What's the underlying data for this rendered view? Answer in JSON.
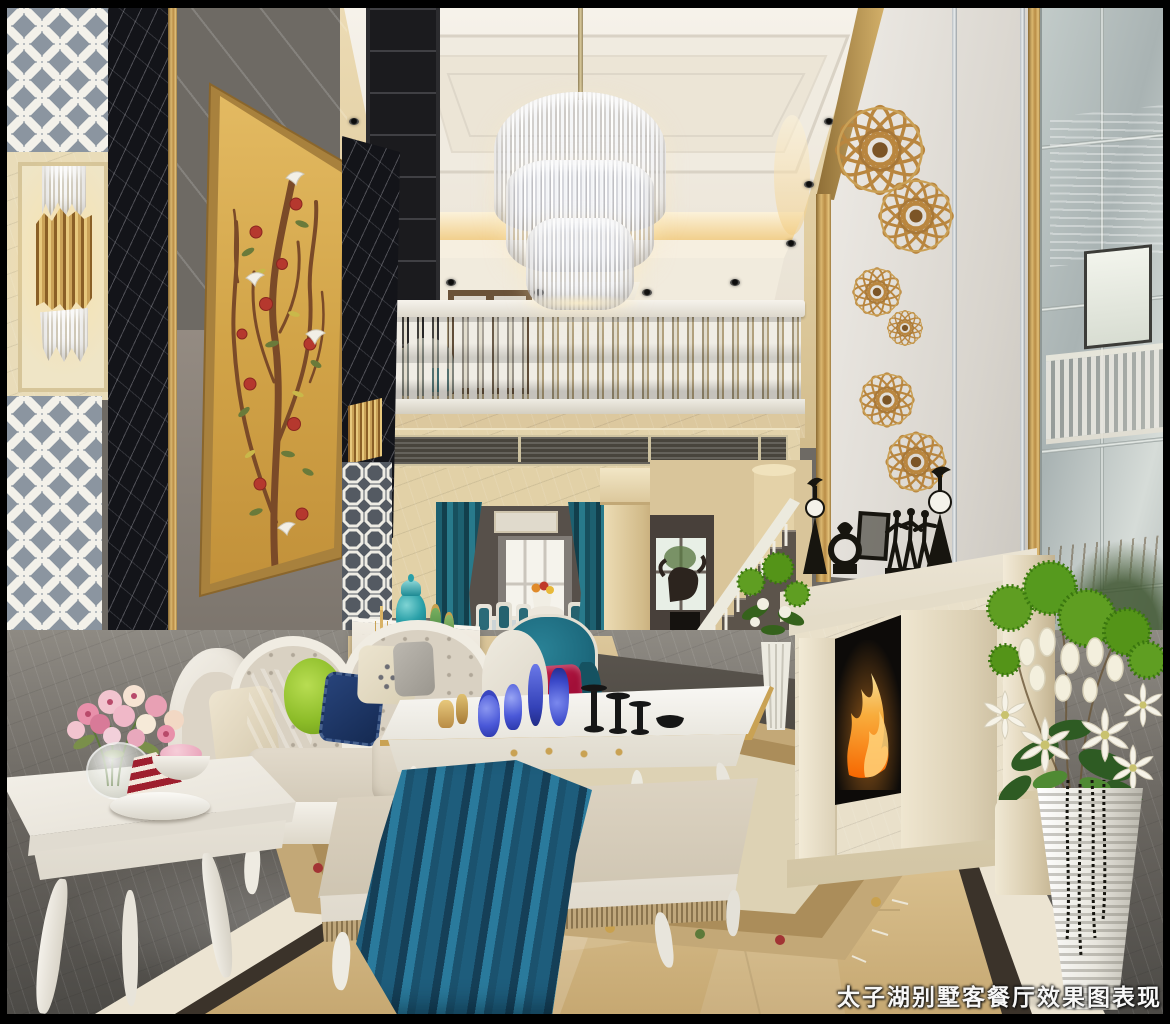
{
  "watermark": {
    "text": "太子湖别墅客餐厅效果图表现"
  },
  "palette": {
    "ceiling_white": "#f4f0e8",
    "cove_glow": "#f2cd84",
    "wall_marble_cream": "#e5d4ab",
    "gold_trim": "#c8a15c",
    "black_marble": "#131419",
    "leather_wall_taupe": "#958d84",
    "painting_gold": "#d4a94e",
    "curtain_teal": "#1d6070",
    "armchair_teal": "#176276",
    "pillow_crimson": "#b3123e",
    "pillow_navy": "#1c3766",
    "pillow_lime": "#9cc832",
    "sofa_cream": "#d9d2c6",
    "throw_blue": "#1f5d7a",
    "floor_center_beige": "#d5bc8a",
    "floor_gray": "#7a766f",
    "rug_tan": "#c3a877",
    "fire_orange": "#ff9a2e",
    "flower_green": "#5f9e22",
    "flower_white": "#f3efdd"
  },
  "objects": [
    "coffered ceiling with cove lighting and spotlights",
    "tiered crystal chandelier",
    "second-floor balcony with white balustrade",
    "gold wire flower wall medallions",
    "marble fireplace with burning fire and black figurine sculptures",
    "mirrored panel wall",
    "gold bird-and-pomegranate wall painting",
    "white octagonal fretwork screens with brass tube sconce",
    "cream carved sofa with green navy and beige pillows",
    "white coffee table with blue glassware",
    "ottoman with teal throw blanket",
    "side table with pink flowers and cake slice",
    "arched dining room with teal curtains",
    "teal wingback armchair with crimson pillow",
    "staircase with white railing",
    "tall white ribbed floor vase with tulips lilies and green pompons",
    "beige marble floor with dark border and floral rug"
  ]
}
